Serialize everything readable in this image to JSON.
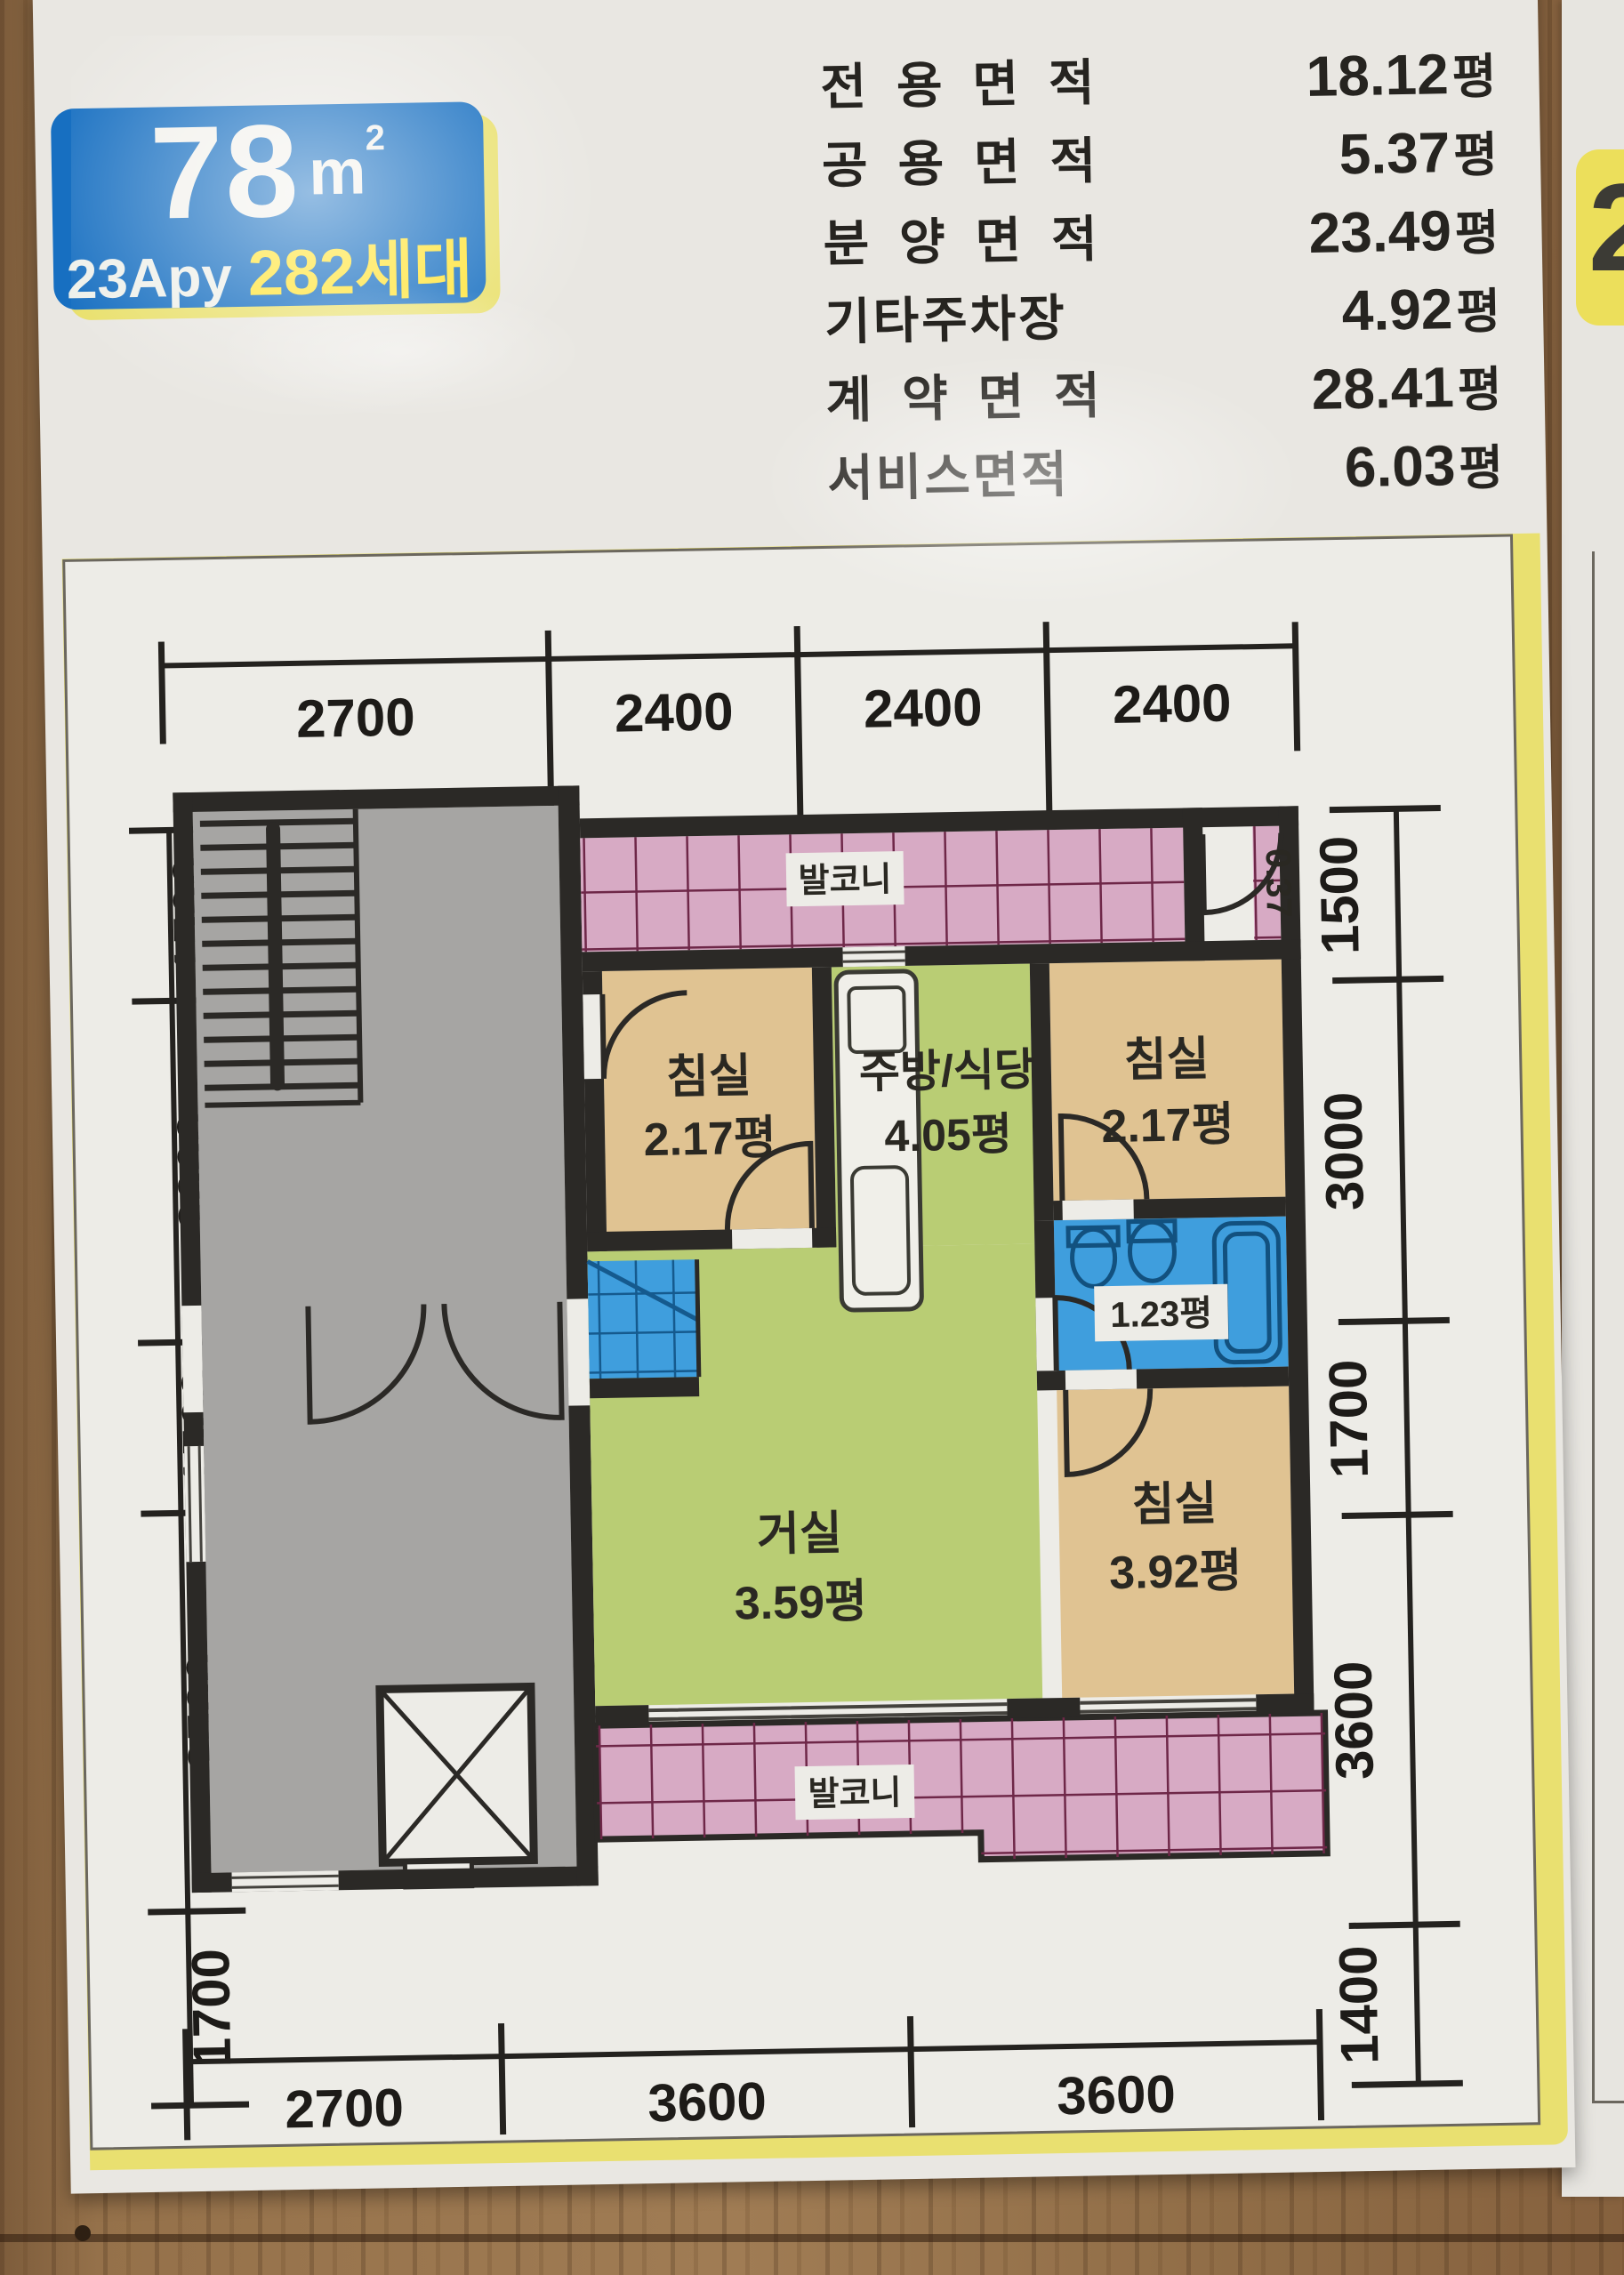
{
  "badge": {
    "area": "78",
    "unit_base": "m",
    "unit_sup": "2",
    "type": "23Apy",
    "households": "282세대"
  },
  "neighbor_badge": {
    "partial_digit": "2"
  },
  "area_table": {
    "rows": [
      {
        "label": "전용면적",
        "value": "18.12",
        "unit": "평"
      },
      {
        "label": "공용면적",
        "value": "5.37",
        "unit": "평"
      },
      {
        "label": "분양면적",
        "value": "23.49",
        "unit": "평"
      },
      {
        "label": "기타주차장",
        "value": "4.92",
        "unit": "평"
      },
      {
        "label": "계약면적",
        "value": "28.41",
        "unit": "평"
      },
      {
        "label": "서비스면적",
        "value": "6.03",
        "unit": "평"
      }
    ]
  },
  "floor_plan": {
    "dims_top": [
      "2700",
      "2400",
      "2400",
      "2400"
    ],
    "dims_left": [
      "1500",
      "3000",
      "1500",
      "3500",
      "1700"
    ],
    "dims_right": [
      "1500",
      "3000",
      "1700",
      "3600",
      "1400"
    ],
    "dims_bottom": [
      "2700",
      "3600",
      "3600"
    ],
    "labels": {
      "balcony_top": "발코니",
      "balcony_bottom": "발코니",
      "bedroom_top_left": "침실",
      "bedroom_top_left_area": "2.17평",
      "kitchen": "주방/식당",
      "kitchen_area": "4.05평",
      "bedroom_top_right": "침실",
      "bedroom_top_right_area": "2.17평",
      "bathroom_area": "1.23평",
      "living": "거실",
      "living_area": "3.59평",
      "bedroom_bottom_right": "침실",
      "bedroom_bottom_right_area": "3.92평",
      "ledge_area": "0.37"
    },
    "colors": {
      "wall": "#2b2926",
      "bedroom": "#e0c392",
      "living": "#b9cd74",
      "balcony": "#d7aac4",
      "bath": "#3f9edd",
      "stairs": "#a6a5a3"
    }
  }
}
